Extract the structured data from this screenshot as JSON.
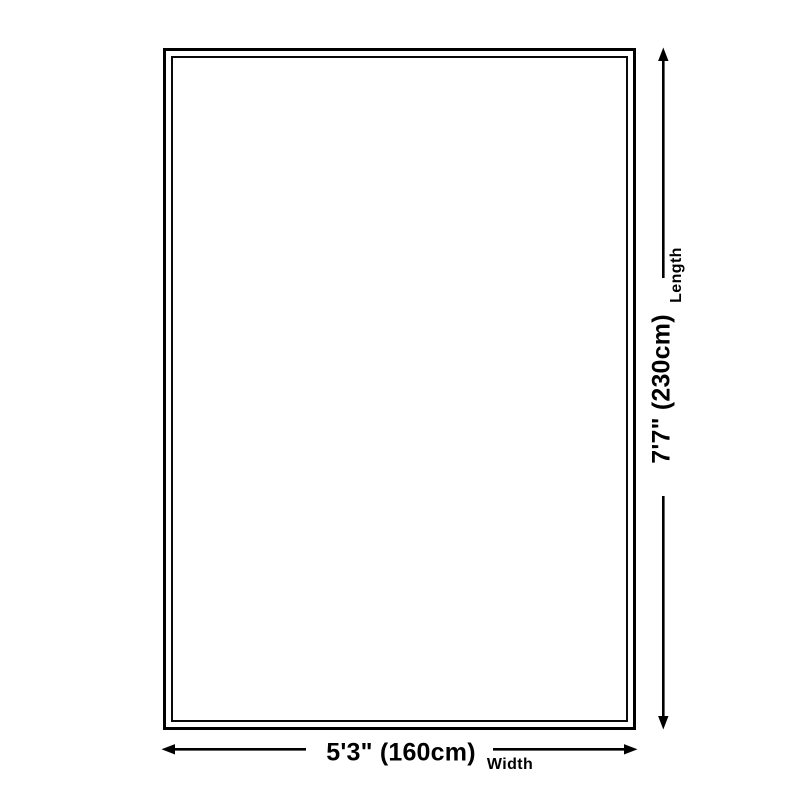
{
  "diagram": {
    "kind": "size-diagram",
    "background_color": "#ffffff",
    "line_color": "#000000",
    "length": {
      "value_label": "7'7\" (230cm)",
      "axis_label": "Length"
    },
    "width": {
      "value_label": "5'3\" (160cm)",
      "axis_label": "Width"
    }
  }
}
